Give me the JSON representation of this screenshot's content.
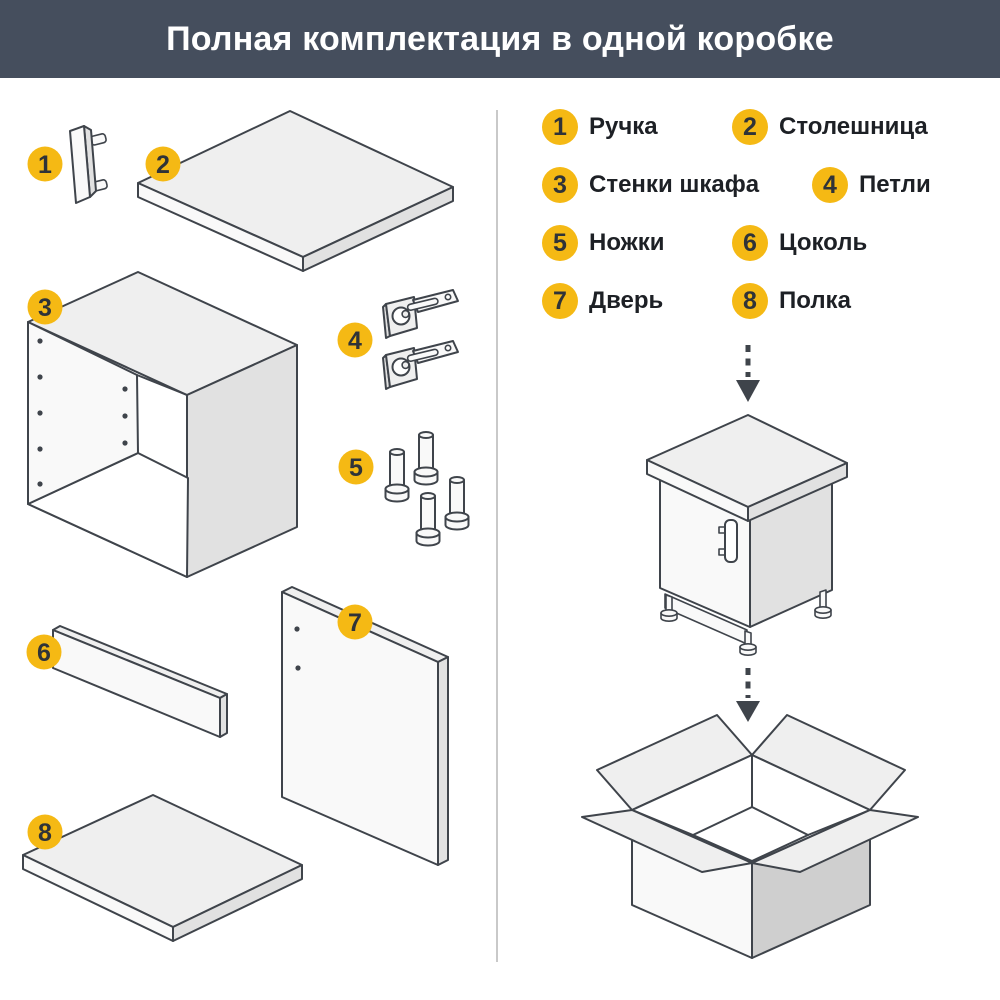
{
  "header": {
    "title": "Полная комплектация в одной коробке"
  },
  "colors": {
    "header-bg": "#454e5d",
    "header-text": "#ffffff",
    "badge": "#f5b914",
    "badge-num": "#2f3338",
    "label-text": "#1d2025",
    "line": "#3f444b",
    "divider": "#c9c9c9",
    "fill-a": "#efefef",
    "fill-b": "#f9f9f9",
    "fill-c": "#e1e1e1",
    "fill-d": "#cfcfcf"
  },
  "legend": {
    "items": [
      {
        "num": "1",
        "label": "Ручка"
      },
      {
        "num": "2",
        "label": "Столешница"
      },
      {
        "num": "3",
        "label": "Стенки шкафа"
      },
      {
        "num": "4",
        "label": "Петли"
      },
      {
        "num": "5",
        "label": "Ножки"
      },
      {
        "num": "6",
        "label": "Цоколь"
      },
      {
        "num": "7",
        "label": "Дверь"
      },
      {
        "num": "8",
        "label": "Полка"
      }
    ]
  }
}
